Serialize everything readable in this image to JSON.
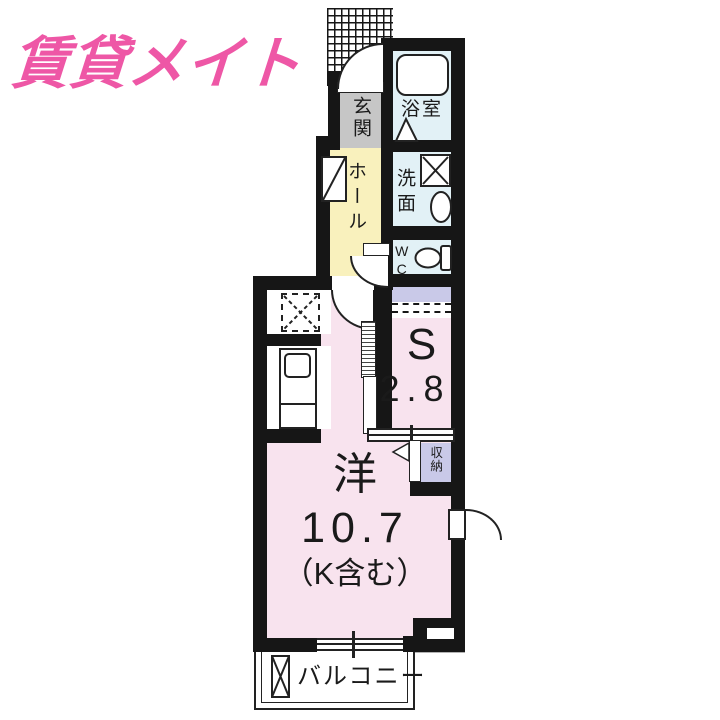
{
  "logo": {
    "text": "賃貸メイト"
  },
  "plan": {
    "entrance": {
      "label": "玄関"
    },
    "bathroom": {
      "label": "浴室"
    },
    "hall": {
      "label": "ホール"
    },
    "washroom": {
      "label": "洗面"
    },
    "toilet": {
      "label": "WC"
    },
    "service_room": {
      "label": "S",
      "area": "2.8"
    },
    "storage": {
      "label": "収納"
    },
    "main_room": {
      "label": "洋",
      "area": "10.7",
      "note": "（K含む）"
    },
    "balcony": {
      "label": "バルコニー"
    }
  },
  "colors": {
    "logo": "#ee57a6",
    "wall": "#161616",
    "room_pink": "#f8e3ee",
    "hall_yellow": "#f9f1bd",
    "wet_area_blue": "#e2f1f6",
    "entrance_gray": "#c6c6c6",
    "closet_purple": "#c9c9e8"
  }
}
